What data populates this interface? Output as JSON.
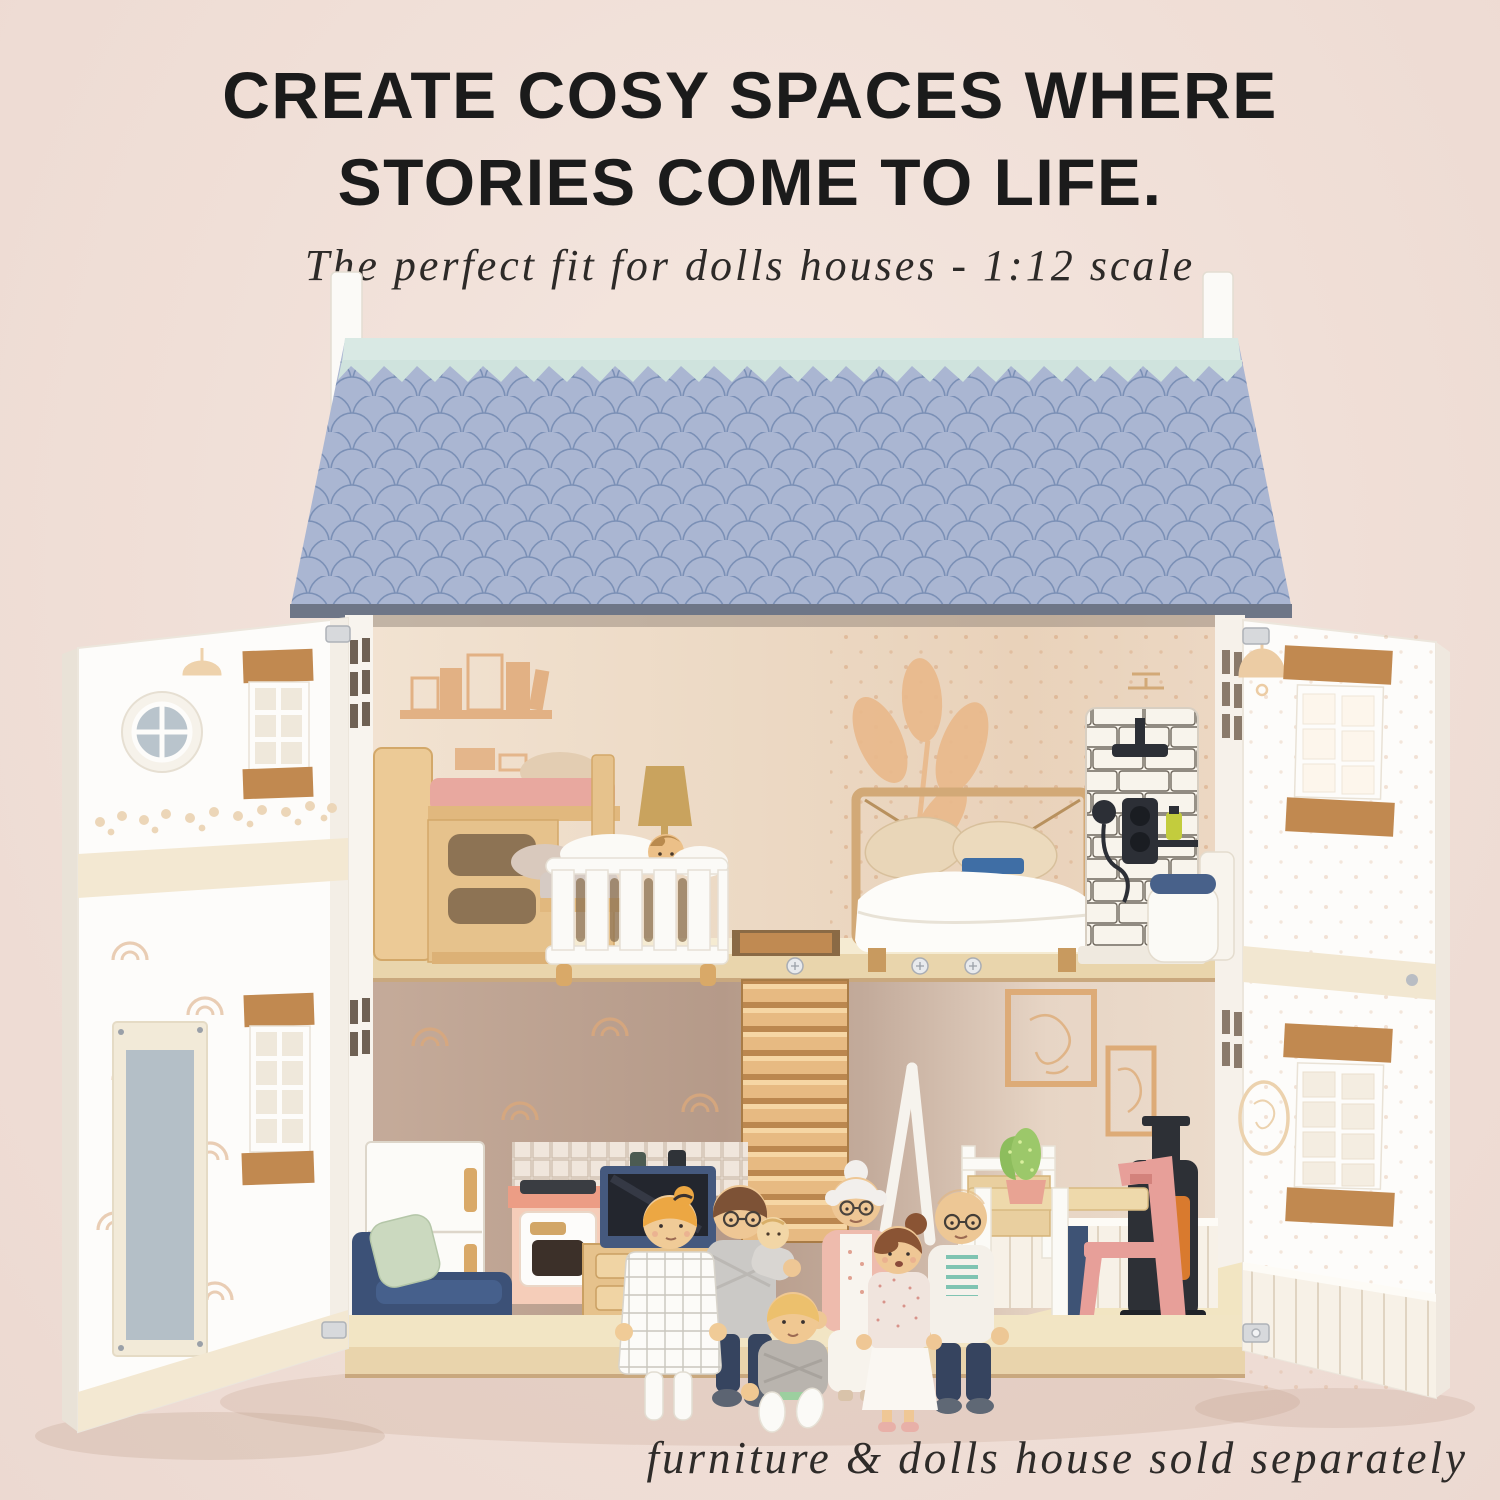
{
  "header": {
    "title_line1": "CREATE COSY SPACES WHERE",
    "title_line2": "STORIES COME TO LIFE.",
    "subtitle": "The perfect fit for dolls houses - 1:12 scale"
  },
  "footer": {
    "disclaimer": "furniture & dolls house sold separately"
  },
  "scene": {
    "subject": "open two-storey wooden dolls house, 1:12 scale, blue fish-scale roof, two white hinged front doors with shuttered windows",
    "upper_floor_items": [
      "bookshelf wall decals",
      "wooden bunk bed with pink and grey bedding",
      "white baby cot with baby doll",
      "mustard floor lamp",
      "leaf wall decal",
      "double bed with white duvet, two pillows and blue book",
      "white subway-tile shower panel with black fittings and yellow bottle",
      "toilet with navy lid",
      "loft hatch in floor"
    ],
    "lower_floor_items": [
      "rainbow wallpaper decals",
      "white fridge with wooden handles",
      "kitchen stove with coral top and tile splashback",
      "two dark bottles",
      "navy TV on wooden media unit",
      "navy sofa with sage cushion",
      "central wooden staircase",
      "white ladder",
      "framed leaf prints",
      "black log-burner stove with orange glow",
      "wooden dining table",
      "white chair",
      "pink chair",
      "potted cactus",
      "white beadboard wainscoting"
    ],
    "dolls": [
      "mother with blonde bun in white check dress",
      "father with glasses holding baby",
      "baby",
      "grandmother with white bun, glasses and pink cardigan",
      "girl with brown bun and white apron",
      "grandfather, bald with glasses, striped top and navy trousers",
      "boy with blond hair sitting"
    ]
  },
  "colors": {
    "bg": "#f0dfd7",
    "bg_light": "#f5e7e0",
    "ink": "#1b1b1b",
    "roof_tile": "#a8b4d0",
    "roof_tile_shadow": "#7b90b6",
    "roof_ridge_mint": "#d9e9e4",
    "chimney_white": "#fbfaf7",
    "wall_upper_cream": "#eedcc8",
    "wall_lower_taupe": "#bfa493",
    "wall_dining_cream": "#e9d8c8",
    "floor_plywood": "#eedcb5",
    "furniture_wood": "#e4bf8b",
    "shutter_wood": "#c18950",
    "door_white": "#fdfcfa",
    "sofa_navy": "#3c5177",
    "cushion_sage": "#cbd9bf",
    "stove_coral": "#ec9d85",
    "tv_navy": "#45597e",
    "chair_pink": "#e79f99",
    "log_burner_black": "#2d3036",
    "burner_glow_orange": "#d97a2e",
    "cactus_green": "#8dbd5d",
    "doll_skin": "#eec795",
    "decal_tan": "#e2b184"
  }
}
